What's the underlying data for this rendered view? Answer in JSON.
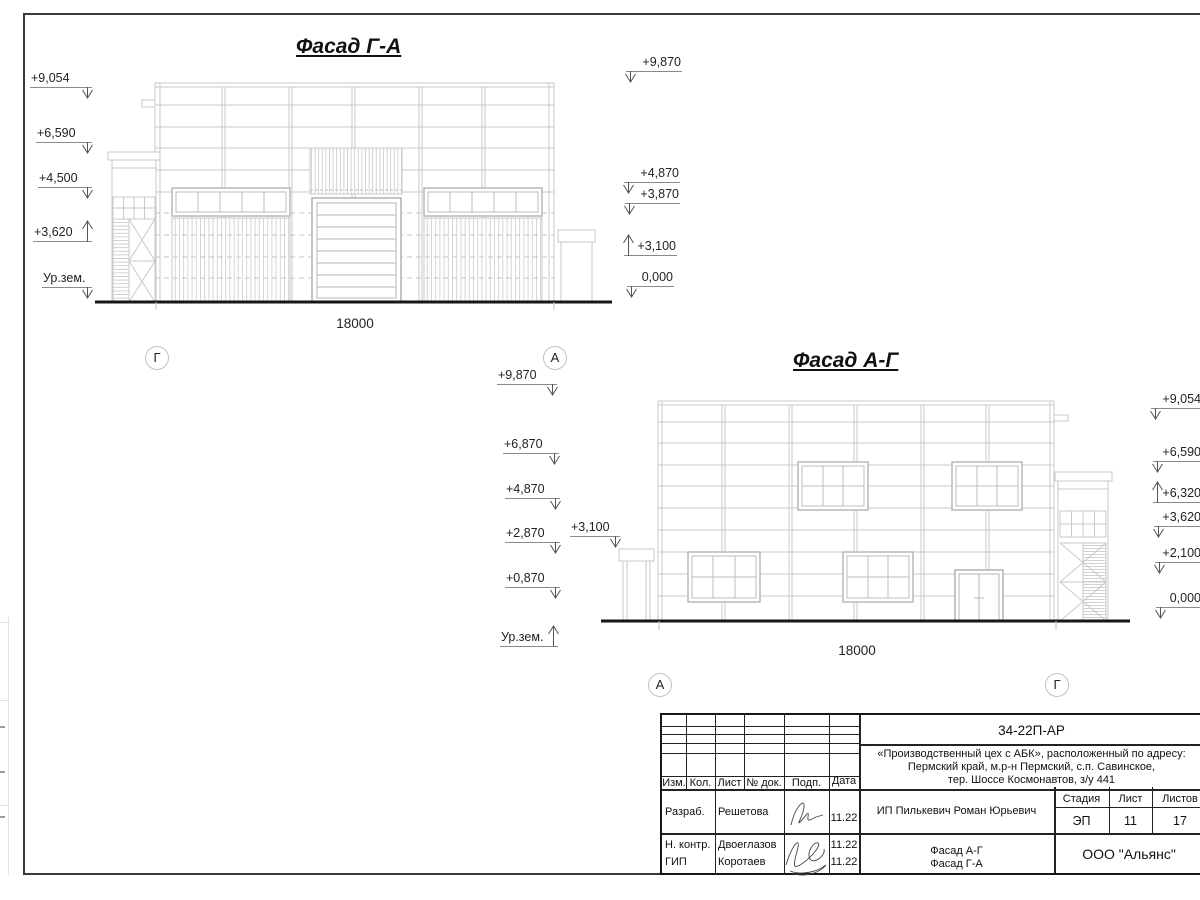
{
  "facade1": {
    "title": "Фасад Г-А",
    "dim": "18000",
    "axis_left": "Г",
    "axis_right": "А",
    "marks_left": [
      "+9,054",
      "+6,590",
      "+4,500",
      "+3,620",
      "Ур.зем."
    ],
    "marks_right": [
      "+9,870",
      "+4,870",
      "+3,870",
      "+3,100",
      "0,000"
    ]
  },
  "facade2": {
    "title": "Фасад А-Г",
    "dim": "18000",
    "axis_left": "А",
    "axis_right": "Г",
    "marks_left": [
      "+9,870",
      "+6,870",
      "+4,870",
      "+2,870",
      "+0,870",
      "Ур.зем."
    ],
    "canopy_mark": "+3,100",
    "marks_right": [
      "+9,054",
      "+6,590",
      "+6,320",
      "+3,620",
      "+2,100",
      "0,000"
    ]
  },
  "title_block": {
    "doc_number": "34-22П-АР",
    "project_line1": "«Производственный цех с АБК», расположенный по адресу:",
    "project_line2": "Пермский край, м.р-н Пермский, с.п. Савинское,",
    "project_line3": "тер. Шоссе Космонавтов, з/у 441",
    "col_izm": "Изм.",
    "col_kol": "Кол.",
    "col_list": "Лист",
    "col_doc": "№ док.",
    "col_podp": "Подп.",
    "col_data": "Дата",
    "role1": "Разраб.",
    "name1": "Решетова",
    "date1": "11.22",
    "role2": "Н. контр.",
    "name2": "Двоеглазов",
    "date2": "11.22",
    "role3": "ГИП",
    "name3": "Коротаев",
    "date3": "11.22",
    "client": "ИП Пилькевич Роман Юрьевич",
    "stage_label": "Стадия",
    "sheet_label": "Лист",
    "sheets_label": "Листов",
    "stage": "ЭП",
    "sheet_no": "11",
    "sheets_total": "17",
    "sheet_title_line1": "Фасад А-Г",
    "sheet_title_line2": "Фасад Г-А",
    "organization": "ООО \"Альянс\""
  },
  "colors": {
    "drawing_line": "#c9c9c9",
    "ground_line": "#161616",
    "text": "#1a1a1a"
  }
}
